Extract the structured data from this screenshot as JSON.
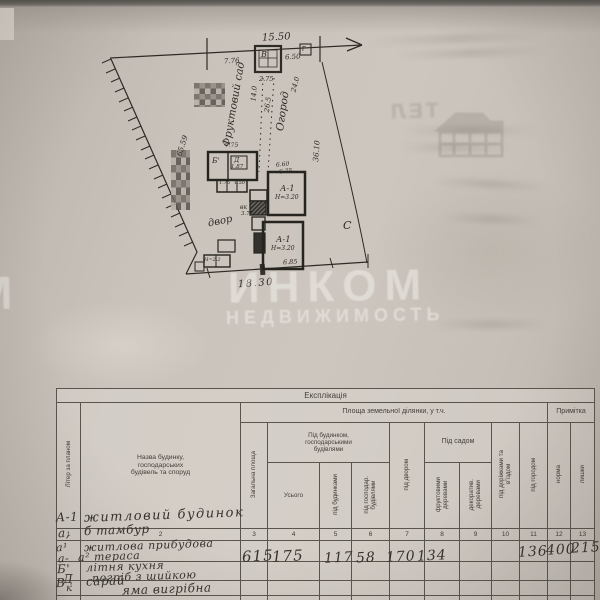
{
  "plan": {
    "dim_top": "15.50",
    "dim_seg_left": "7.76",
    "dim_seg_right": "6.50",
    "corner_marker": "Г",
    "outbuilding_label": "В",
    "dim_outbuilding": "2.75",
    "area_orchard": "Фруктовий сад",
    "dim_orchard": "14.0",
    "area_garden": "Огород",
    "dim_garden_1": "26.5",
    "dim_garden_2": "24.0",
    "dim_side_left": "65.59",
    "dim_side_right": "36.10",
    "yard_label": "двор",
    "north_mark": "С",
    "bld_summer_kitchen": "Б'",
    "bld_cellar": "Д",
    "dim_kitchen_top": "7.75",
    "dim_kitchen_inner": "1.87",
    "dim_small_1": "1.75",
    "dim_small_2": "1.50",
    "shed_label": "вк",
    "dim_shed": "3.77",
    "shed_height": "Н=2.2",
    "bld_house_upper": "А-1",
    "house_upper_height": "Н=3.20",
    "dim_house_1": "6.60",
    "dim_house_2": "6.75",
    "bld_house_lower": "А-1",
    "house_lower_height": "Н=3.20",
    "dim_house_lower": "6.85",
    "dim_bottom": "18.30"
  },
  "bleed_through": {
    "line1": "ТЕЛ"
  },
  "watermark": {
    "brand": "ИНКОМ",
    "sub": "НЕДВИЖИМОСТЬ",
    "edge_letter": "М"
  },
  "table": {
    "title": "Експлікація",
    "headers": {
      "letter": "Літер за планом",
      "name": "Назва будинку,\nгосподарських\nбудівель та споруд",
      "area_group": "Площа земельної ділянки, у т.ч.",
      "note_group": "Примітка",
      "total_area": "Загальна площа",
      "house_group": "Під будинком,\nгосподарськими\nбудівлями",
      "total": "Усього",
      "under_house": "під будинками",
      "under_outbuildings": "під господар.\nбудівлями",
      "under_yard": "під двором",
      "garden_group": "Під садом",
      "fruit_trees": "фруктовими\nдеревами",
      "decorative_trees": "декоратив.\nдеревами",
      "under_paths": "під доріжками та\nв'їздом",
      "under_vegetable": "під городом",
      "norm": "норма",
      "surplus": "лишки"
    },
    "column_numbers": [
      "1",
      "2",
      "3",
      "4",
      "5",
      "6",
      "7",
      "8",
      "9",
      "10",
      "11",
      "12",
      "13"
    ],
    "rows": [
      {
        "letter": "А-1",
        "name": "житловий будинок"
      },
      {
        "letter": "а,",
        "name": "б тамбур"
      },
      {
        "letter": "а¹",
        "name": "житлова прибудова"
      },
      {
        "letter": "а-",
        "name": "а² тераса"
      },
      {
        "letter": "Б'",
        "letter2": "Д",
        "name": "літня кухня",
        "name2": "погріб з шийкою"
      },
      {
        "letter": "В",
        "letter2": "к",
        "name": "сарай",
        "name2": "яма вигрібна"
      }
    ],
    "values": {
      "total_area": "615",
      "total": "175",
      "under_house": "117",
      "under_outbuildings": "58",
      "under_yard": "170",
      "fruit_trees": "134",
      "under_vegetable": "136",
      "norm": "400",
      "surplus": "215"
    }
  }
}
